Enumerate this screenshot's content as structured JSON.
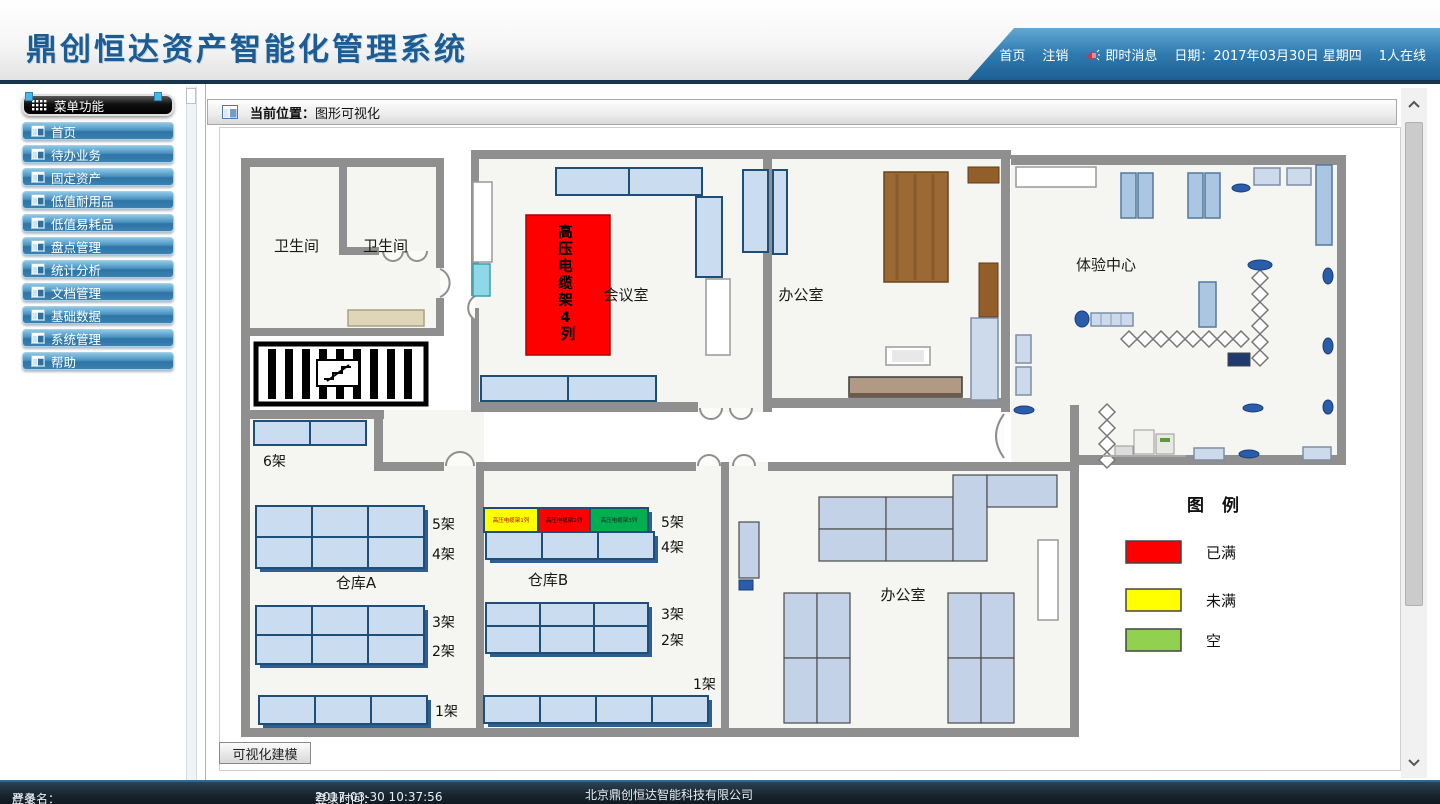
{
  "header": {
    "title": "鼎创恒达资产智能化管理系统",
    "nav": {
      "home": "首页",
      "logout": "注销",
      "messages": "即时消息",
      "date_label": "日期：",
      "date": "2017年03月30日 星期四",
      "online": "1人在线"
    }
  },
  "sidebar": {
    "header": "菜单功能",
    "items": [
      {
        "label": "首页"
      },
      {
        "label": "待办业务"
      },
      {
        "label": "固定资产"
      },
      {
        "label": "低值耐用品"
      },
      {
        "label": "低值易耗品"
      },
      {
        "label": "盘点管理"
      },
      {
        "label": "统计分析"
      },
      {
        "label": "文档管理"
      },
      {
        "label": "基础数据"
      },
      {
        "label": "系统管理"
      },
      {
        "label": "帮助"
      }
    ]
  },
  "breadcrumb": {
    "label": "当前位置：",
    "value": "图形可视化"
  },
  "floorplan": {
    "rooms": {
      "restroom1": "卫生间",
      "restroom2": "卫生间",
      "meeting": "会议室",
      "office_top": "办公室",
      "experience": "体验中心",
      "warehouse_a": "仓库A",
      "warehouse_b": "仓库B",
      "office_bottom": "办公室"
    },
    "racks": {
      "hv4_chars": [
        "高",
        "压",
        "电",
        "缆",
        "架",
        "4",
        "列"
      ],
      "hv1": "高压电缆架1列",
      "hv2": "高压电缆架2列",
      "hv3": "高压电缆架3列"
    },
    "shelves": {
      "a6": "6架",
      "a5": "5架",
      "a4": "4架",
      "a3": "3架",
      "a2": "2架",
      "a1": "1架",
      "b5": "5架",
      "b4": "4架",
      "b3": "3架",
      "b2": "2架",
      "b1": "1架"
    },
    "legend": {
      "title": "图  例",
      "items": [
        {
          "label": "已满",
          "color": "#FF0000"
        },
        {
          "label": "未满",
          "color": "#FFFF00"
        },
        {
          "label": "空",
          "color": "#92D050"
        }
      ]
    },
    "status_colors": {
      "full": "#FF0000",
      "not_full": "#FFFF00",
      "empty": "#00B050"
    }
  },
  "toolbar": {
    "modeling_button": "可视化建模"
  },
  "statusbar": {
    "login_name_label": "登录名：",
    "login_name": "严冬",
    "login_time_label": "登录时间：  ",
    "login_time": "2017-03-30 10:37:56",
    "company": "北京鼎创恒达智能科技有限公司"
  }
}
